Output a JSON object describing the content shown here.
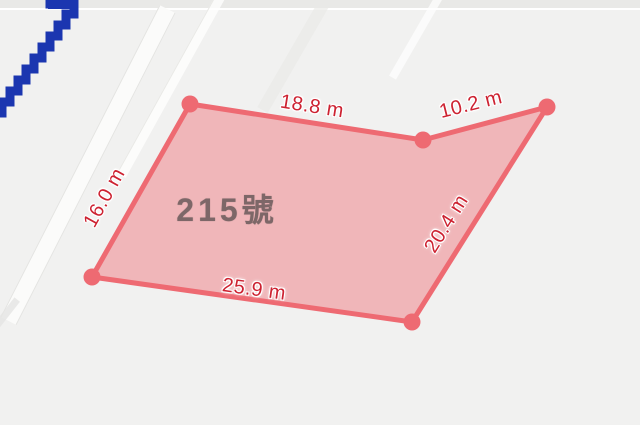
{
  "map": {
    "background_color": "#f1f1f0",
    "route_line": {
      "color": "#1b36b0",
      "description": "blue pixelated boundary line, upper left"
    },
    "parcel": {
      "number_label": "215號",
      "fill_color": "#ee6a72",
      "fill_opacity": 0.44,
      "stroke_color": "#ee6a72",
      "stroke_width": 5,
      "vertex_color": "#ee6a72",
      "vertex_radius": 8.5,
      "vertices": [
        [
          190,
          104
        ],
        [
          423,
          140
        ],
        [
          547,
          107
        ],
        [
          412,
          322
        ],
        [
          92,
          277
        ]
      ],
      "measurement_color": "#cd2231",
      "measurements": [
        {
          "side": "top",
          "text": "18.8 m",
          "x": 312,
          "y": 107,
          "rotation": 9
        },
        {
          "side": "top-right",
          "text": "10.2 m",
          "x": 471,
          "y": 105,
          "rotation": -14
        },
        {
          "side": "right",
          "text": "20.4 m",
          "x": 447,
          "y": 224,
          "rotation": -58
        },
        {
          "side": "bottom",
          "text": "25.9 m",
          "x": 254,
          "y": 290,
          "rotation": 8
        },
        {
          "side": "left",
          "text": "16.0 m",
          "x": 105,
          "y": 198,
          "rotation": -61
        }
      ]
    }
  }
}
